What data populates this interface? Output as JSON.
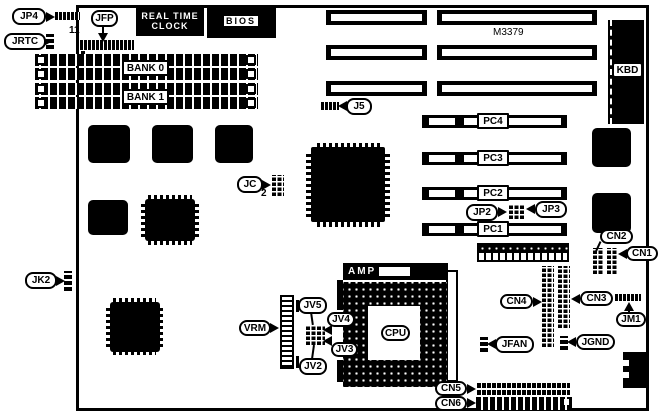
{
  "colors": {
    "ink": "#000000",
    "paper": "#ffffff"
  },
  "board": {
    "chips": {
      "rtc_line1": "REAL TIME",
      "rtc_line2": "CLOCK",
      "bios": "BIOS",
      "chipset": "M3379",
      "cpu": "CPU",
      "amp": "AMP",
      "vrm": "VRM"
    },
    "memory": {
      "bank0": "BANK 0",
      "bank1": "BANK 1"
    },
    "slots": {
      "pc1": "PC1",
      "pc2": "PC2",
      "pc3": "PC3",
      "pc4": "PC4"
    },
    "connectors": {
      "kbd": "KBD",
      "cn1": "CN1",
      "cn2": "CN2",
      "cn3": "CN3",
      "cn4": "CN4",
      "cn5": "CN5",
      "cn6": "CN6"
    },
    "jumpers": {
      "jp4": "JP4",
      "jrtc": "JRTC",
      "jfp": "JFP",
      "j5": "J5",
      "jp2": "JP2",
      "jp3": "JP3",
      "jc": "JC",
      "jk2": "JK2",
      "jm1": "JM1",
      "jv2": "JV2",
      "jv3": "JV3",
      "jv4": "JV4",
      "jv5": "JV5",
      "jfan": "JFAN",
      "jgnd": "JGND"
    },
    "notes": {
      "pin11": "11",
      "pin2": "2"
    }
  }
}
